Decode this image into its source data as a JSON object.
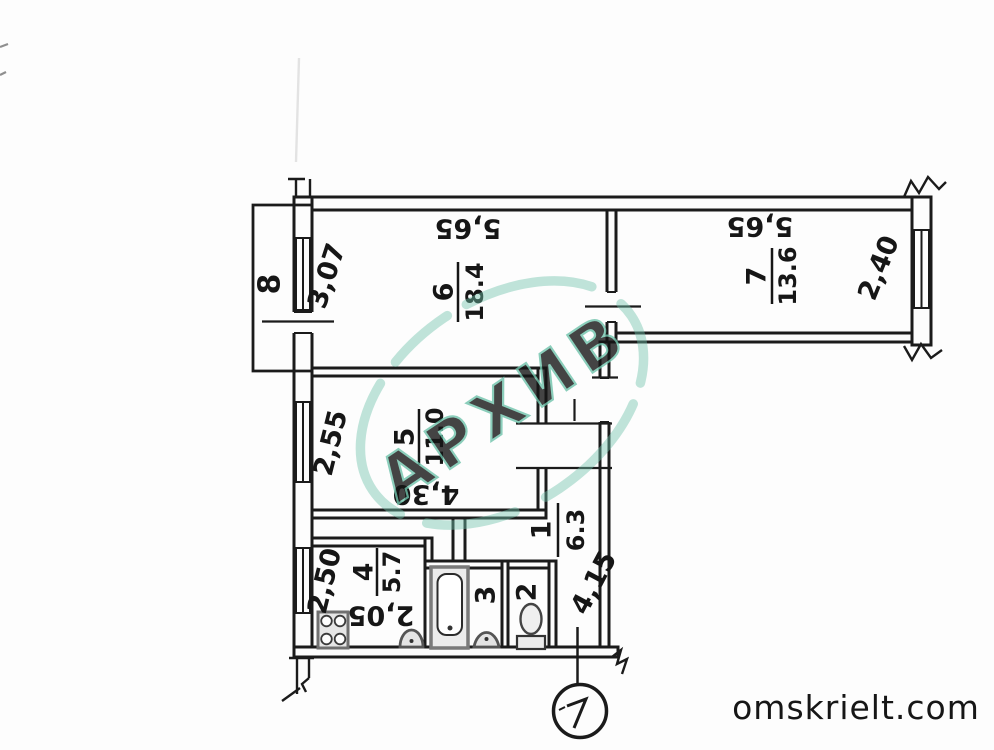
{
  "watermark": {
    "stamp_text": "АРХИВ",
    "stamp_color": "#6fc3ab",
    "site_text": "omskrielt.com",
    "site_color": "#c9c9c9"
  },
  "rooms": {
    "r1": {
      "number": "1",
      "area": "6.3"
    },
    "r2": {
      "number": "2"
    },
    "r3": {
      "number": "3"
    },
    "r4": {
      "number": "4",
      "area": "5.7"
    },
    "r5": {
      "number": "5",
      "area": "11.0"
    },
    "r6": {
      "number": "6",
      "area": "18.4"
    },
    "r7": {
      "number": "7",
      "area": "13.6"
    },
    "r8": {
      "number": "8"
    }
  },
  "dims": {
    "room6_width": "5,65",
    "room6_depth": "3,07",
    "room7_width": "5,65",
    "room7_depth": "2,40",
    "room5_depth": "2,55",
    "room5_width": "4,30",
    "kitchen_depth": "2,50",
    "kitchen_width": "2,05",
    "hall_length": "4,15"
  }
}
